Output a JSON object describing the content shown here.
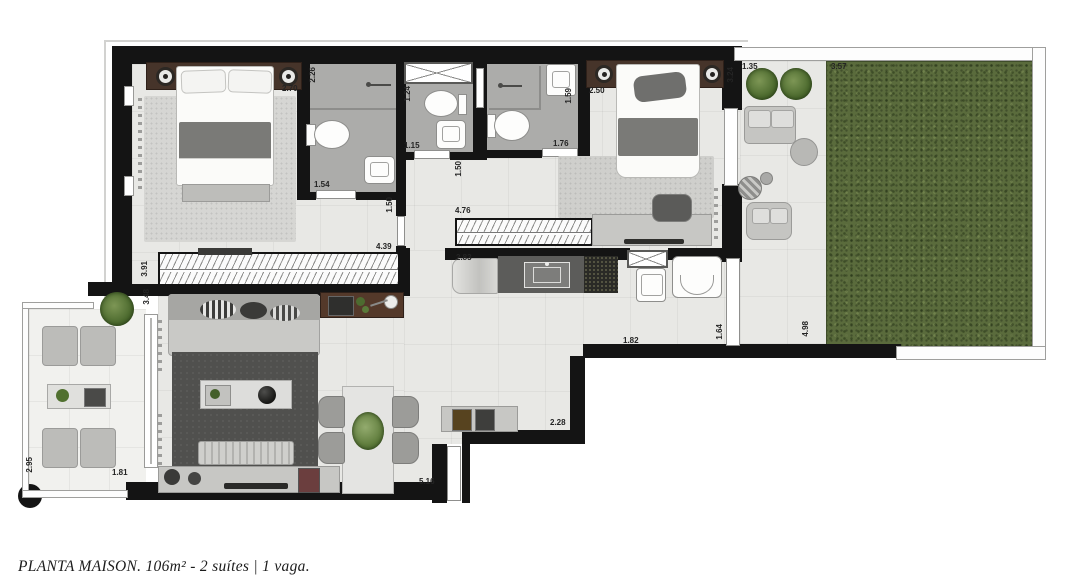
{
  "caption": {
    "text": "PLANTA MAISON. 106m² - 2 suítes | 1 vaga."
  },
  "plan": {
    "name": "Planta Maison",
    "area_label": "106m²",
    "suites_label": "2 suítes",
    "parking_label": "1 vaga",
    "colors": {
      "wall": "#141414",
      "floor_tile": "#e8e8e5",
      "bathroom_floor": "#acacaa",
      "grass": "#5a6b3c",
      "wood_furniture": "#46342a",
      "caption_text": "#1c1c1c"
    },
    "dimension_labels": [
      {
        "text": "2.70",
        "x": 282,
        "y": 85,
        "vertical": false
      },
      {
        "text": "2.26",
        "x": 309,
        "y": 67,
        "vertical": true
      },
      {
        "text": "1.54",
        "x": 314,
        "y": 181,
        "vertical": false
      },
      {
        "text": "1.24",
        "x": 404,
        "y": 86,
        "vertical": true
      },
      {
        "text": "1.15",
        "x": 404,
        "y": 142,
        "vertical": false
      },
      {
        "text": "1.59",
        "x": 565,
        "y": 88,
        "vertical": true
      },
      {
        "text": "1.76",
        "x": 553,
        "y": 140,
        "vertical": false
      },
      {
        "text": "2.50",
        "x": 589,
        "y": 87,
        "vertical": false
      },
      {
        "text": "3.24",
        "x": 727,
        "y": 67,
        "vertical": true
      },
      {
        "text": "1.35",
        "x": 742,
        "y": 63,
        "vertical": false
      },
      {
        "text": "3.57",
        "x": 831,
        "y": 63,
        "vertical": false
      },
      {
        "text": "1.50",
        "x": 386,
        "y": 197,
        "vertical": true
      },
      {
        "text": "1.50",
        "x": 455,
        "y": 161,
        "vertical": true
      },
      {
        "text": "3.91",
        "x": 141,
        "y": 261,
        "vertical": true
      },
      {
        "text": "4.39",
        "x": 376,
        "y": 243,
        "vertical": false
      },
      {
        "text": "3.48",
        "x": 143,
        "y": 289,
        "vertical": true
      },
      {
        "text": "4.76",
        "x": 455,
        "y": 207,
        "vertical": false
      },
      {
        "text": "2.83",
        "x": 456,
        "y": 254,
        "vertical": false
      },
      {
        "text": "1.82",
        "x": 623,
        "y": 337,
        "vertical": false
      },
      {
        "text": "1.64",
        "x": 716,
        "y": 324,
        "vertical": true
      },
      {
        "text": "4.98",
        "x": 802,
        "y": 321,
        "vertical": true
      },
      {
        "text": "2.28",
        "x": 550,
        "y": 419,
        "vertical": false
      },
      {
        "text": "5.16",
        "x": 419,
        "y": 478,
        "vertical": false
      },
      {
        "text": "1.81",
        "x": 112,
        "y": 469,
        "vertical": false
      },
      {
        "text": "2.95",
        "x": 26,
        "y": 457,
        "vertical": true
      }
    ]
  }
}
